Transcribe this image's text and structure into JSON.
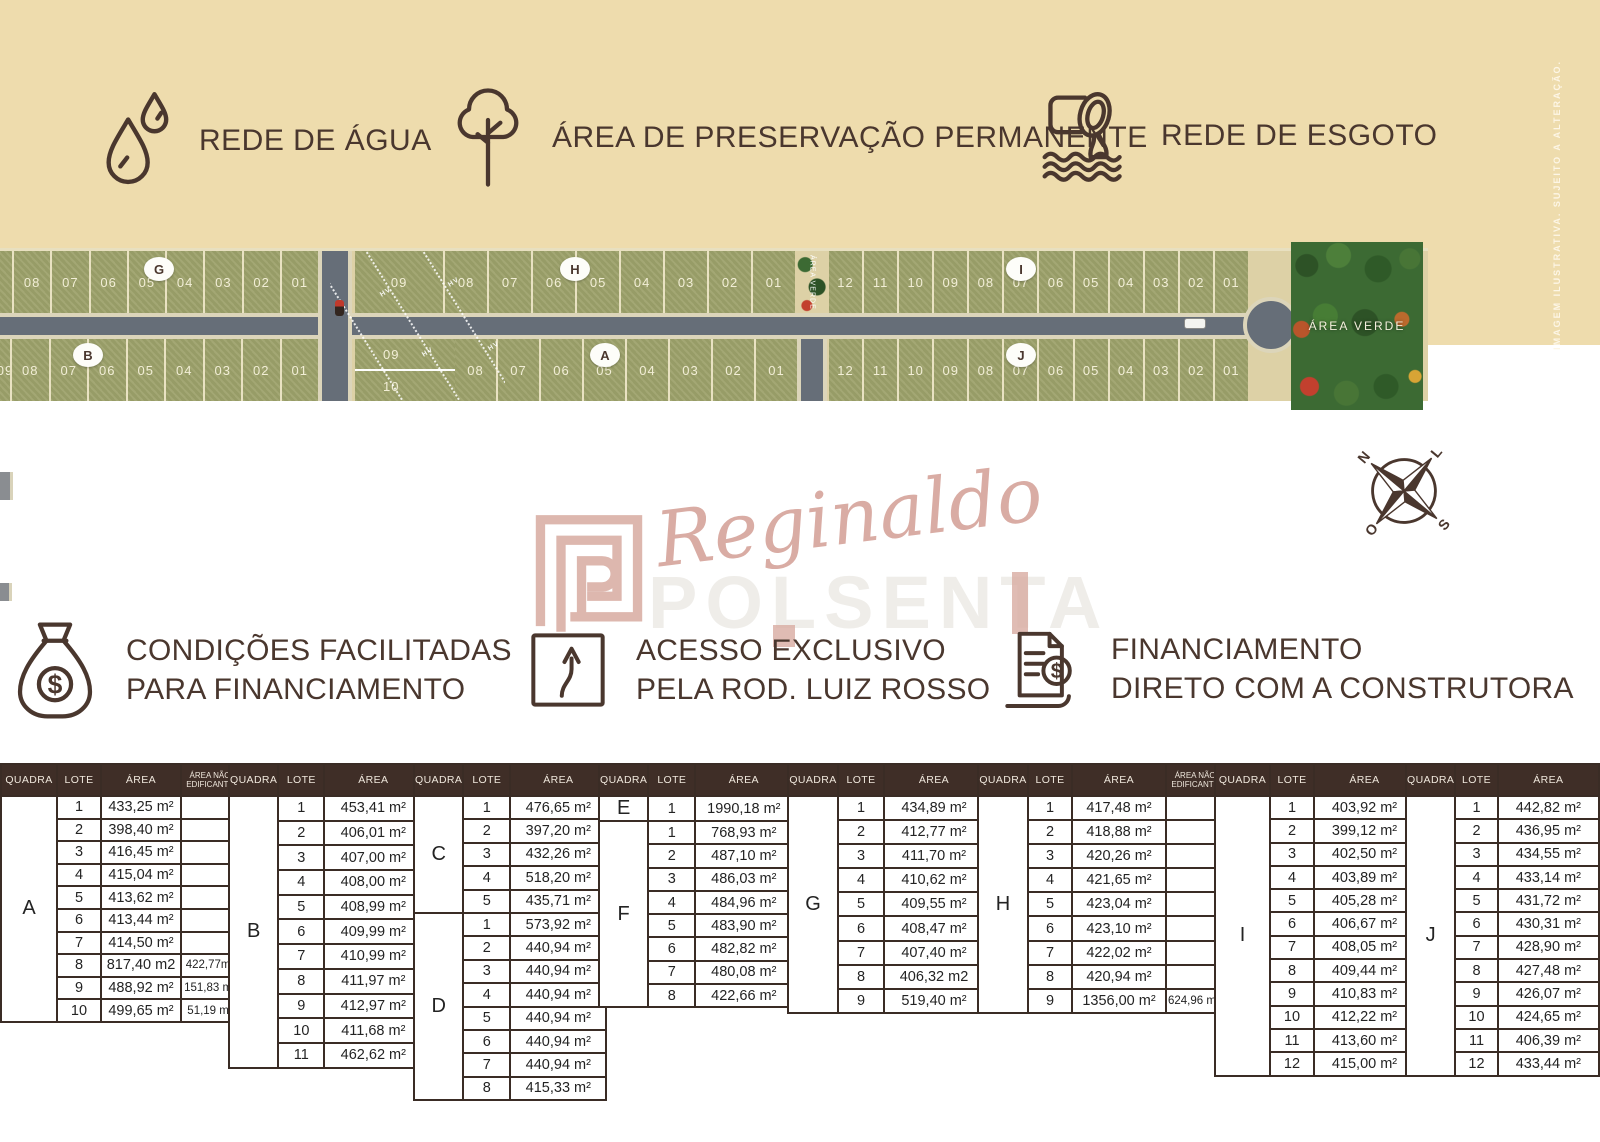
{
  "page": {
    "disclaimer": "IMAGEM ILUSTRATIVA. SUJEITO A ALTERAÇÃO."
  },
  "legend": {
    "items": [
      {
        "icon": "water-drops-icon",
        "label": "REDE DE ÁGUA"
      },
      {
        "icon": "tree-icon",
        "label": "ÁREA DE PRESERVAÇÃO PERMANENTE"
      },
      {
        "icon": "sewage-pipe-icon",
        "label": "REDE DE ESGOTO"
      }
    ]
  },
  "map": {
    "area_verde_label": "ÁREA VERDE",
    "powerline_label": "HV",
    "colors": {
      "lot_green": "#9da26b",
      "road_gray": "#666e78",
      "sand": "#ddd1a6",
      "forest_green": "#3c6a33"
    },
    "top_row": [
      {
        "quadra": "G",
        "badge_lot": "05",
        "lots": [
          "",
          "08",
          "07",
          "06",
          "05",
          "04",
          "03",
          "02",
          "01"
        ]
      },
      {
        "quadra": "H",
        "badge_lot": "05",
        "lots": [
          "09",
          "08",
          "07",
          "06",
          "05",
          "04",
          "03",
          "02",
          "01"
        ]
      },
      {
        "quadra": "I",
        "badge_lot": "07",
        "lots": [
          "12",
          "11",
          "10",
          "09",
          "08",
          "07",
          "06",
          "05",
          "04",
          "03",
          "02",
          "01"
        ]
      }
    ],
    "bottom_row": [
      {
        "quadra": "B",
        "badge_lot": "07",
        "lots": [
          "09",
          "08",
          "07",
          "06",
          "05",
          "04",
          "03",
          "02",
          "01"
        ]
      },
      {
        "quadra": "A",
        "badge_lot": "05",
        "stacked_lots": [
          "09",
          "10"
        ],
        "lots": [
          "08",
          "07",
          "06",
          "05",
          "04",
          "03",
          "02",
          "01"
        ]
      },
      {
        "quadra": "J",
        "badge_lot": "07",
        "lots": [
          "12",
          "11",
          "10",
          "09",
          "08",
          "07",
          "06",
          "05",
          "04",
          "03",
          "02",
          "01"
        ]
      }
    ]
  },
  "compass": {
    "north": "N",
    "south": "S",
    "east": "L",
    "west": "O"
  },
  "watermark": {
    "signature": "Reginaldo",
    "ghost_text": "POLSENTA"
  },
  "benefits": {
    "items": [
      {
        "icon": "money-bag-icon",
        "line1": "CONDIÇÕES FACILITADAS",
        "line2": "PARA FINANCIAMENTO"
      },
      {
        "icon": "road-sign-icon",
        "line1": "ACESSO EXCLUSIVO",
        "line2": "PELA ROD. LUIZ ROSSO"
      },
      {
        "icon": "invoice-icon",
        "line1": "FINANCIAMENTO",
        "line2": "DIRETO COM A CONSTRUTORA"
      }
    ]
  },
  "tables": {
    "headers": {
      "quadra": "QUADRA",
      "lote": "LOTE",
      "area": "ÁREA",
      "area_nao": "ÁREA NÃO EDIFICANTE"
    },
    "groups": [
      {
        "id": "A",
        "has_nao": true,
        "sections": [
          {
            "quadra": "A",
            "rows": [
              [
                "1",
                "433,25 m²",
                ""
              ],
              [
                "2",
                "398,40 m²",
                ""
              ],
              [
                "3",
                "416,45 m²",
                ""
              ],
              [
                "4",
                "415,04 m²",
                ""
              ],
              [
                "5",
                "413,62 m²",
                ""
              ],
              [
                "6",
                "413,44 m²",
                ""
              ],
              [
                "7",
                "414,50 m²",
                ""
              ],
              [
                "8",
                "817,40 m2",
                "422,77m²"
              ],
              [
                "9",
                "488,92 m²",
                "151,83 m²"
              ],
              [
                "10",
                "499,65 m²",
                "51,19 m²"
              ]
            ]
          }
        ]
      },
      {
        "id": "B",
        "has_nao": false,
        "sections": [
          {
            "quadra": "B",
            "rows": [
              [
                "1",
                "453,41 m²"
              ],
              [
                "2",
                "406,01 m²"
              ],
              [
                "3",
                "407,00 m²"
              ],
              [
                "4",
                "408,00 m²"
              ],
              [
                "5",
                "408,99 m²"
              ],
              [
                "6",
                "409,99 m²"
              ],
              [
                "7",
                "410,99 m²"
              ],
              [
                "8",
                "411,97 m²"
              ],
              [
                "9",
                "412,97 m²"
              ],
              [
                "10",
                "411,68 m²"
              ],
              [
                "11",
                "462,62 m²"
              ]
            ]
          }
        ]
      },
      {
        "id": "CD",
        "has_nao": false,
        "sections": [
          {
            "quadra": "C",
            "rows": [
              [
                "1",
                "476,65 m²"
              ],
              [
                "2",
                "397,20 m²"
              ],
              [
                "3",
                "432,26 m²"
              ],
              [
                "4",
                "518,20 m²"
              ],
              [
                "5",
                "435,71 m²"
              ]
            ]
          },
          {
            "quadra": "D",
            "rows": [
              [
                "1",
                "573,92 m²"
              ],
              [
                "2",
                "440,94 m²"
              ],
              [
                "3",
                "440,94 m²"
              ],
              [
                "4",
                "440,94 m²"
              ],
              [
                "5",
                "440,94 m²"
              ],
              [
                "6",
                "440,94 m²"
              ],
              [
                "7",
                "440,94 m²"
              ],
              [
                "8",
                "415,33 m²"
              ]
            ]
          }
        ]
      },
      {
        "id": "EF",
        "has_nao": false,
        "sections": [
          {
            "quadra": "E",
            "rows": [
              [
                "1",
                "1990,18 m²"
              ]
            ]
          },
          {
            "quadra": "F",
            "rows": [
              [
                "1",
                "768,93 m²"
              ],
              [
                "2",
                "487,10 m²"
              ],
              [
                "3",
                "486,03 m²"
              ],
              [
                "4",
                "484,96 m²"
              ],
              [
                "5",
                "483,90 m²"
              ],
              [
                "6",
                "482,82 m²"
              ],
              [
                "7",
                "480,08 m²"
              ],
              [
                "8",
                "422,66 m²"
              ]
            ]
          }
        ]
      },
      {
        "id": "G",
        "has_nao": false,
        "sections": [
          {
            "quadra": "G",
            "rows": [
              [
                "1",
                "434,89 m²"
              ],
              [
                "2",
                "412,77 m²"
              ],
              [
                "3",
                "411,70 m²"
              ],
              [
                "4",
                "410,62 m²"
              ],
              [
                "5",
                "409,55 m²"
              ],
              [
                "6",
                "408,47 m²"
              ],
              [
                "7",
                "407,40 m²"
              ],
              [
                "8",
                "406,32 m2"
              ],
              [
                "9",
                "519,40 m²"
              ]
            ]
          }
        ]
      },
      {
        "id": "H",
        "has_nao": true,
        "sections": [
          {
            "quadra": "H",
            "rows": [
              [
                "1",
                "417,48 m²",
                ""
              ],
              [
                "2",
                "418,88 m²",
                ""
              ],
              [
                "3",
                "420,26 m²",
                ""
              ],
              [
                "4",
                "421,65 m²",
                ""
              ],
              [
                "5",
                "423,04 m²",
                ""
              ],
              [
                "6",
                "423,10 m²",
                ""
              ],
              [
                "7",
                "422,02 m²",
                ""
              ],
              [
                "8",
                "420,94 m²",
                ""
              ],
              [
                "9",
                "1356,00 m²",
                "624,96 m2"
              ]
            ]
          }
        ]
      },
      {
        "id": "I",
        "has_nao": false,
        "sections": [
          {
            "quadra": "I",
            "rows": [
              [
                "1",
                "403,92 m²"
              ],
              [
                "2",
                "399,12 m²"
              ],
              [
                "3",
                "402,50 m²"
              ],
              [
                "4",
                "403,89 m²"
              ],
              [
                "5",
                "405,28 m²"
              ],
              [
                "6",
                "406,67 m²"
              ],
              [
                "7",
                "408,05 m²"
              ],
              [
                "8",
                "409,44 m²"
              ],
              [
                "9",
                "410,83 m²"
              ],
              [
                "10",
                "412,22 m²"
              ],
              [
                "11",
                "413,60 m²"
              ],
              [
                "12",
                "415,00 m²"
              ]
            ]
          }
        ]
      },
      {
        "id": "J",
        "has_nao": false,
        "sections": [
          {
            "quadra": "J",
            "rows": [
              [
                "1",
                "442,82 m²"
              ],
              [
                "2",
                "436,95 m²"
              ],
              [
                "3",
                "434,55 m²"
              ],
              [
                "4",
                "433,14 m²"
              ],
              [
                "5",
                "431,72 m²"
              ],
              [
                "6",
                "430,31 m²"
              ],
              [
                "7",
                "428,90 m²"
              ],
              [
                "8",
                "427,48 m²"
              ],
              [
                "9",
                "426,07 m²"
              ],
              [
                "10",
                "424,65 m²"
              ],
              [
                "11",
                "406,39 m²"
              ],
              [
                "12",
                "433,44 m²"
              ]
            ]
          }
        ]
      }
    ]
  }
}
